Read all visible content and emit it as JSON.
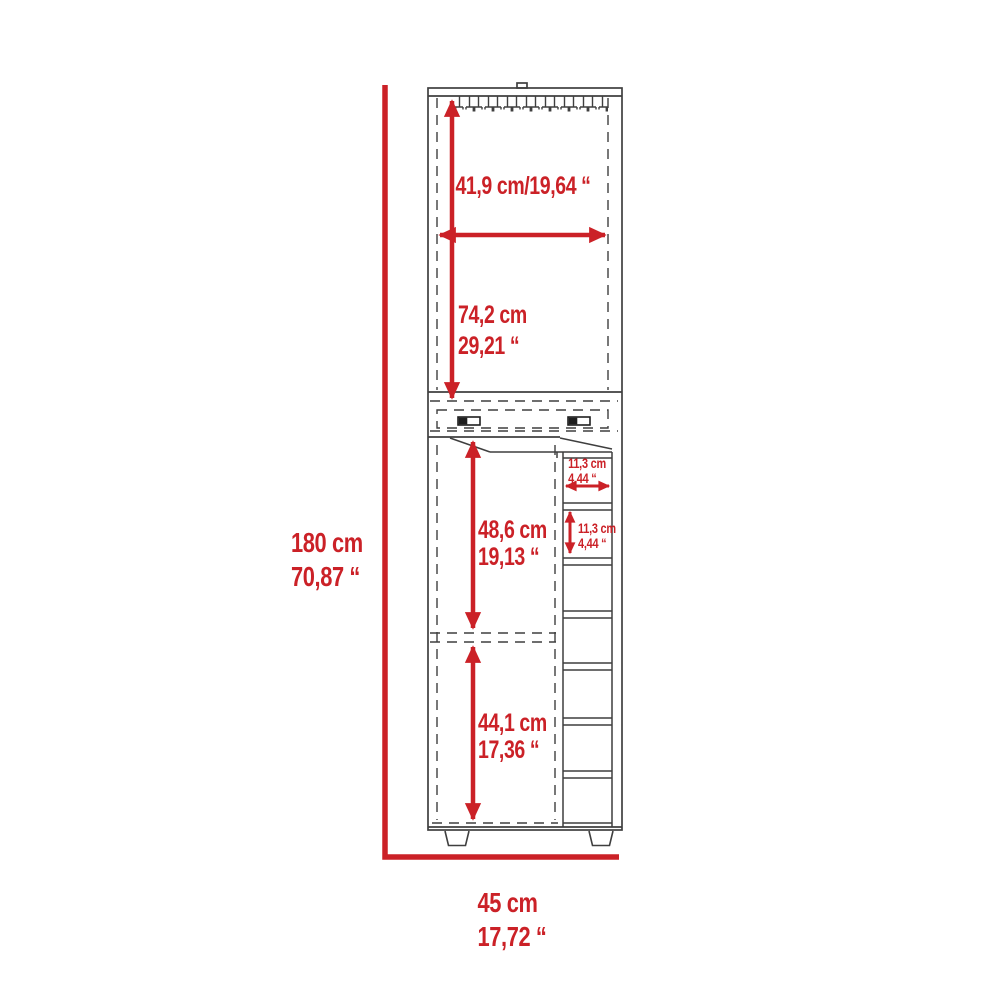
{
  "diagram": {
    "labels": {
      "top_width": {
        "text": "41,9 cm/19,64 “"
      },
      "upper_height": {
        "cm": "74,2 cm",
        "inch": "29,21 “"
      },
      "total_height": {
        "cm": "180 cm",
        "inch": "70,87 “"
      },
      "middle_height": {
        "cm": "48,6 cm",
        "inch": "19,13 “"
      },
      "lower_height": {
        "cm": "44,1 cm",
        "inch": "17,36 “"
      },
      "base_width": {
        "cm": "45 cm",
        "inch": "17,72 “"
      },
      "cubby_width": {
        "cm": "11,3 cm",
        "inch": "4,44 “"
      },
      "cubby_height": {
        "cm": "11,3 cm",
        "inch": "4,44 “"
      }
    },
    "colors": {
      "dimension_red": "#cb2127",
      "line_gray": "#3f3f3f",
      "background": "#ffffff"
    }
  }
}
